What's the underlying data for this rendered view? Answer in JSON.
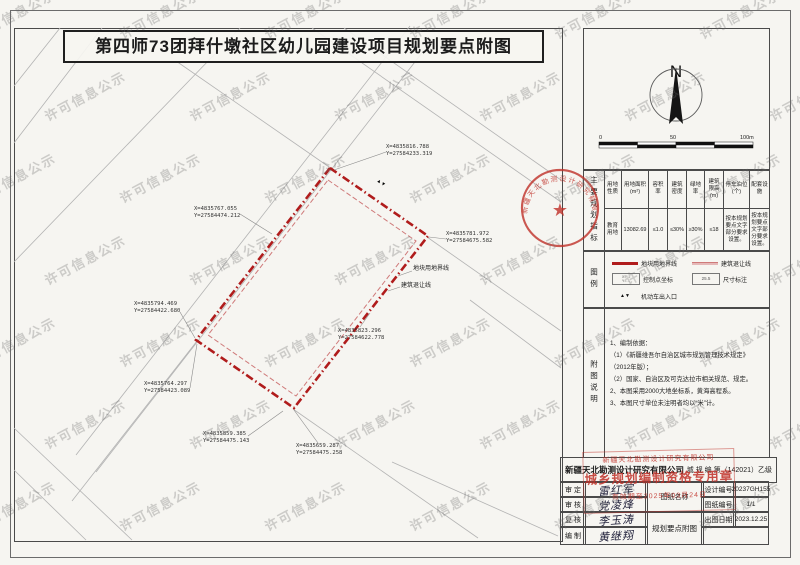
{
  "title": "第四师73团拜什墩社区幼儿园建设项目规划要点附图",
  "watermark": "许可信息公示",
  "compass": {
    "label": "N"
  },
  "scale_bar": {
    "ticks": [
      "0",
      "50",
      "100m"
    ]
  },
  "indicators": {
    "section_label": "主要规划指标",
    "headers": [
      "用地性质",
      "用地面积(m²)",
      "容积率",
      "建筑密度",
      "绿地率",
      "建筑限高(m)",
      "停车泊位(个)",
      "配套设施"
    ],
    "values": [
      "教育用地",
      "13082.69",
      "≤1.0",
      "≤30%",
      "≥30%",
      "≤18",
      "按本规划要点文字部分要求设置。",
      "按本规划要点文字部分要求设置。"
    ]
  },
  "legend": {
    "section_label": "图例",
    "items": [
      {
        "label": "地块用地界线"
      },
      {
        "label": "建筑退让线"
      },
      {
        "label": "控制点坐标",
        "sample1": "X=…",
        "sample2": "Y=…"
      },
      {
        "label": "尺寸标注",
        "sample": "25.5"
      },
      {
        "label": "机动车出入口",
        "sample": "▲▼"
      }
    ]
  },
  "notes": {
    "section_label": "附图说明",
    "lines": [
      "1、编制依据：",
      "（1）《新疆维吾尔自治区城市规划管理技术规定》（2012年版）；",
      "（2）国家、自治区及可克达拉市相关规范、规定。",
      "2、本图采用2000大地坐标系，黄海高程系。",
      "3、本图尺寸单位未注明者均以“米”计。"
    ]
  },
  "map": {
    "boundary_label": "地块用地界线",
    "setback_label": "建筑退让线",
    "entrance_symbol": "▲▼",
    "round_stamp_text": "新疆天北勘测设计研究有限公司",
    "coords": [
      {
        "x": 386,
        "y": 144,
        "line1": "X=4835816.788",
        "line2": "Y=27584233.319",
        "leader": [
          386,
          152,
          334,
          170
        ]
      },
      {
        "x": 194,
        "y": 206,
        "line1": "X=4835767.055",
        "line2": "Y=27584474.212",
        "leader": [
          240,
          214,
          272,
          234
        ]
      },
      {
        "x": 446,
        "y": 231,
        "line1": "X=4835781.972",
        "line2": "Y=27584675.582",
        "leader": [
          446,
          239,
          429,
          237
        ]
      },
      {
        "x": 134,
        "y": 301,
        "line1": "X=4835794.469",
        "line2": "Y=27584422.680",
        "leader": [
          180,
          312,
          195,
          338
        ]
      },
      {
        "x": 338,
        "y": 328,
        "line1": "X=4835823.296",
        "line2": "Y=27584622.778",
        "leader": [
          360,
          327,
          370,
          313
        ]
      },
      {
        "x": 144,
        "y": 381,
        "line1": "X=4835764.297",
        "line2": "Y=27584423.089",
        "leader": [
          190,
          388,
          197,
          344
        ]
      },
      {
        "x": 203,
        "y": 431,
        "line1": "X=4835859.385",
        "line2": "Y=27584475.143",
        "leader": [
          248,
          436,
          283,
          411
        ]
      },
      {
        "x": 296,
        "y": 443,
        "line1": "X=4835659.287",
        "line2": "Y=27584475.258",
        "leader": [
          318,
          443,
          294,
          410
        ]
      }
    ]
  },
  "title_block": {
    "company": "新疆天北勘测设计研究有限公司",
    "cert": "城 规 编 第（142021）乙级",
    "stamp": {
      "line1": "新疆天北勘测设计研究有限公司",
      "line2": "城乡规划编制资格专用章",
      "line3": "有效期至2025年03月24日"
    },
    "rows": [
      {
        "label": "审 定",
        "sig": "雷红军"
      },
      {
        "label": "审 核",
        "sig": "党凌烽"
      },
      {
        "label": "复 核",
        "sig": "李玉涛"
      },
      {
        "label": "编 制",
        "sig": "黄继翔"
      }
    ],
    "drawing_name_label": "图纸名称",
    "drawing_name": "规划要点附图",
    "meta": [
      {
        "label": "设计编号",
        "value": "20237GH155"
      },
      {
        "label": "图纸编号",
        "value": "1/1"
      },
      {
        "label": "出图日期",
        "value": "2023.12.25"
      }
    ]
  }
}
